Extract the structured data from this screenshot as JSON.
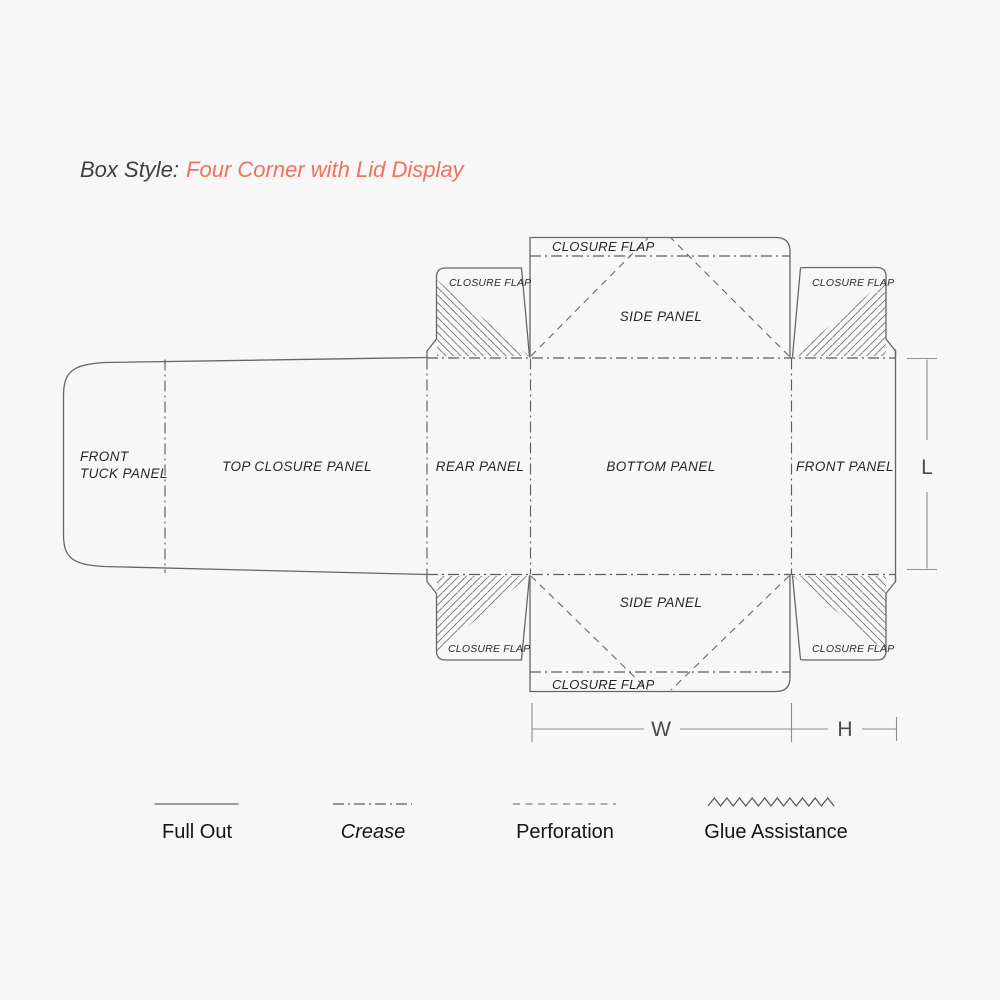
{
  "title": {
    "prefix": "Box Style:",
    "style_name": "Four Corner with Lid Display"
  },
  "colors": {
    "accent": "#f2705c",
    "line": "#666666",
    "text": "#262626",
    "background": "#f7f7f8"
  },
  "diagram": {
    "panels": {
      "front_tuck_line1": "FRONT",
      "front_tuck_line2": "TUCK PANEL",
      "top_closure": "TOP CLOSURE PANEL",
      "rear": "REAR PANEL",
      "bottom": "BOTTOM PANEL",
      "front": "FRONT PANEL",
      "side_top": "SIDE PANEL",
      "side_bottom": "SIDE PANEL",
      "closure_flap": "CLOSURE FLAP"
    },
    "dimensions": {
      "length": "L",
      "width": "W",
      "height": "H"
    }
  },
  "legend": {
    "items": [
      {
        "label": "Full Out",
        "line_style": "solid"
      },
      {
        "label": "Crease",
        "line_style": "dash-dot"
      },
      {
        "label": "Perforation",
        "line_style": "dashed"
      },
      {
        "label": "Glue Assistance",
        "line_style": "zigzag"
      }
    ]
  }
}
